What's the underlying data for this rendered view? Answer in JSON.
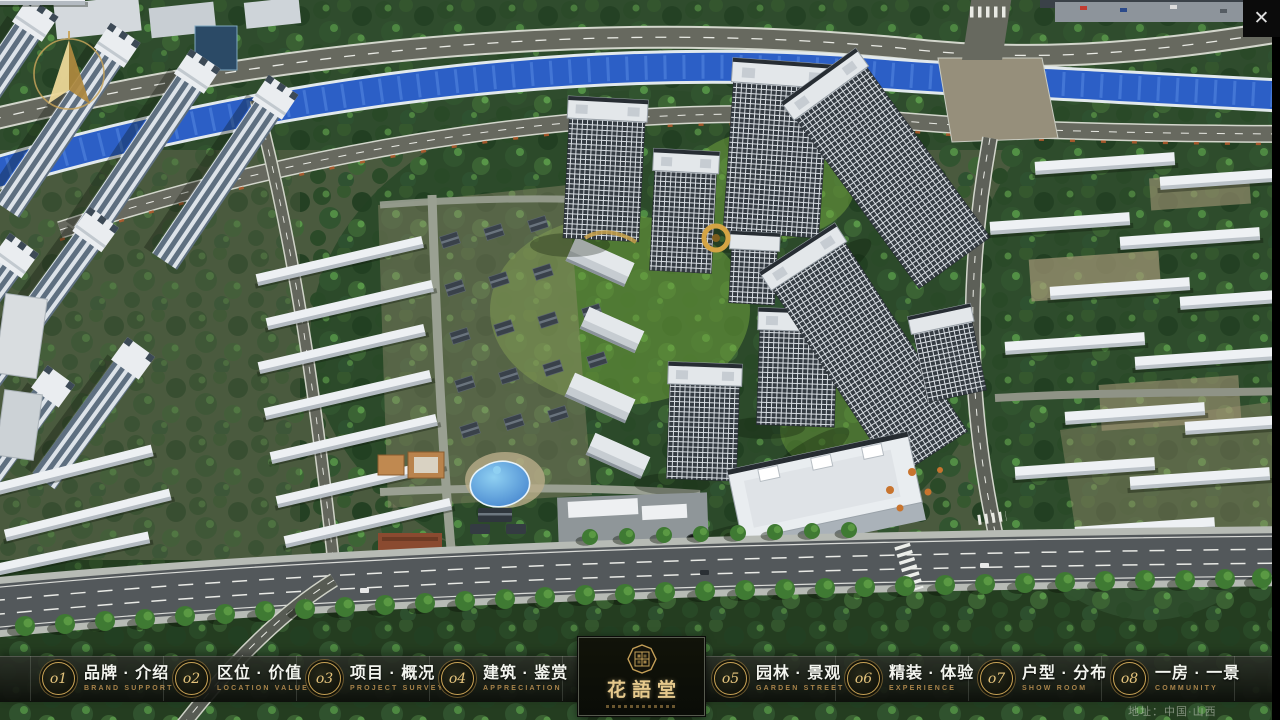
{
  "nav": {
    "items": [
      {
        "num": "o1",
        "zh": "品牌 · 介绍",
        "en": "BRAND SUPPORT"
      },
      {
        "num": "o2",
        "zh": "区位 · 价值",
        "en": "LOCATION VALUE"
      },
      {
        "num": "o3",
        "zh": "项目 · 概况",
        "en": "PROJECT SURVEY"
      },
      {
        "num": "o4",
        "zh": "建筑 · 鉴赏",
        "en": "APPRECIATION"
      },
      {
        "num": "o5",
        "zh": "园林 · 景观",
        "en": "GARDEN STREET"
      },
      {
        "num": "o6",
        "zh": "精装 · 体验",
        "en": "EXPERIENCE"
      },
      {
        "num": "o7",
        "zh": "户型 · 分布",
        "en": "SHOW ROOM"
      },
      {
        "num": "o8",
        "zh": "一房 · 一景",
        "en": "COMMUNITY"
      }
    ]
  },
  "logo": {
    "name": "花語堂"
  },
  "footer": {
    "address": "地址：中国·山西"
  },
  "icons": {
    "close_glyph": "✕"
  },
  "colors": {
    "gold": "#c8a255",
    "gold_text": "#e6c98c",
    "nav_caption": "#a8834a",
    "bar_background": "rgba(12,14,10,0.92)",
    "river_blue": "#2c5fc6",
    "tree_green": "#2c4a2a",
    "lawn_green": "#6fa23c",
    "road_gray": "#53585b",
    "roof_white": "#e9edf0"
  }
}
